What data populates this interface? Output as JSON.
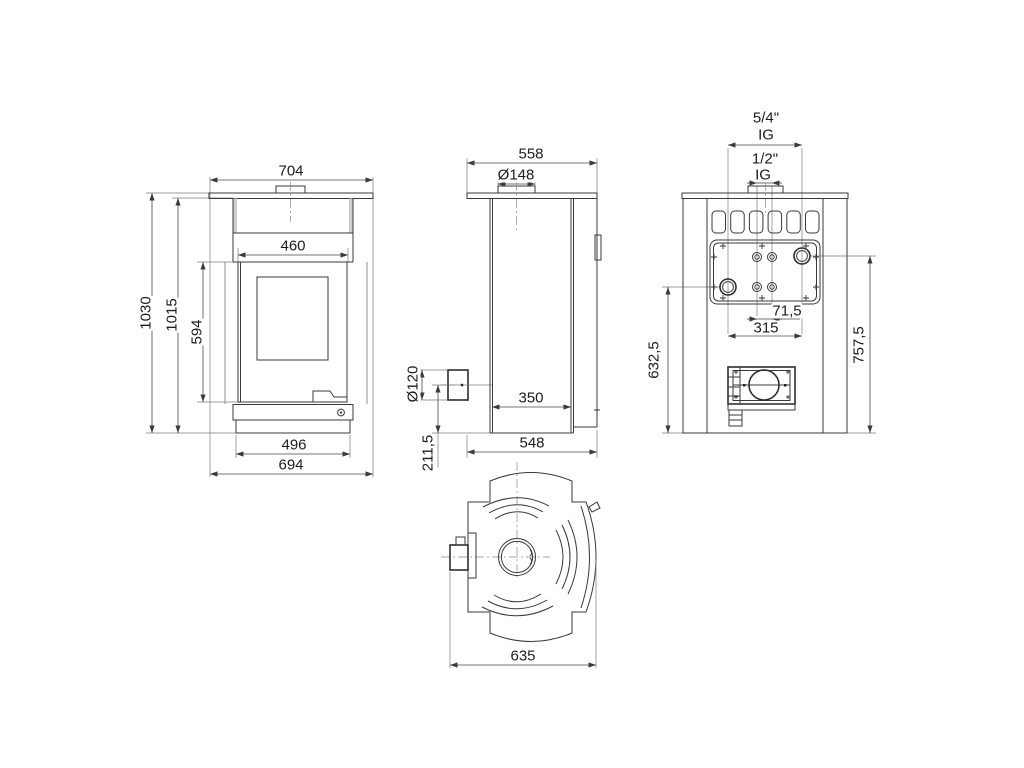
{
  "drawing": {
    "type": "stove-technical-dimension-drawing",
    "background": "#fffffe",
    "line_color": "#3a3a3a",
    "plate_fill": "#c2c2c2",
    "panel_strip_fill": "#cdcdcd"
  },
  "dims": {
    "front": {
      "top_width": "704",
      "opening_width": "460",
      "total_height": "1030",
      "body_height": "1015",
      "door_height": "594",
      "plinth_width": "496",
      "base_width": "694"
    },
    "side": {
      "top_depth": "558",
      "collar_diameter": "Ø148",
      "rear_flue_diameter": "Ø120",
      "rear_flue_height": "211,5",
      "firebox_depth": "350",
      "base_depth": "548"
    },
    "rear": {
      "flow_conn_size": "5/4\"",
      "flow_conn_thread": "IG",
      "sensor_conn_size": "1/2\"",
      "sensor_conn_thread": "IG",
      "sensor_spacing": "71,5",
      "conn_spacing": "315",
      "return_height": "632,5",
      "flow_height": "757,5"
    },
    "top": {
      "total_depth": "635"
    }
  }
}
